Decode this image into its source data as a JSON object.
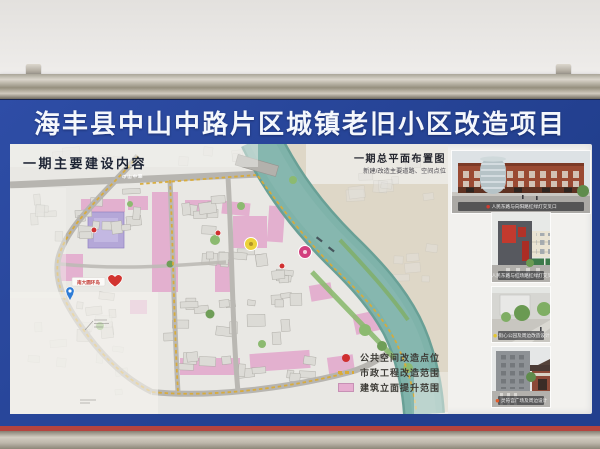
{
  "header": {
    "title": "海丰县中山中路片区城镇老旧小区改造项目"
  },
  "map": {
    "section_title": "一期主要建设内容",
    "plan_title": "一期总平面布置图",
    "plan_subtitle": "新建/改造主要道路、空间点位",
    "road_label": "中山中路",
    "poi_label": "南大圆环岛",
    "legend": [
      {
        "label": "公共空间改造点位",
        "marker": "red-dot",
        "color": "#cf2f2f"
      },
      {
        "label": "市政工程改造范围",
        "marker": "orange-dashed-line",
        "color": "#d9ab38"
      },
      {
        "label": "建筑立面提升范围",
        "marker": "pink-area",
        "color": "#e3abcd"
      }
    ]
  },
  "photos": [
    {
      "caption": "人民东路与向阳路红绿灯交叉口",
      "dot_color": "#d23c30"
    },
    {
      "caption": "人民东路与红场路红绿灯交叉口",
      "dot_color": "#d23c30"
    },
    {
      "caption": "街心公园及周边改造设计",
      "dot_color": "#e4c62e"
    },
    {
      "caption": "灵符宫广场及周边设计",
      "dot_color": "#e05a2a"
    }
  ],
  "colors": {
    "board_blue": "#2b4a9c",
    "accent_red": "#b5443e",
    "frame_metal": "#c9c3b7",
    "river_teal": "#7fb3aa",
    "facade_pink": "#e3abcd",
    "municipal_yellow": "#d9ab38",
    "public_point_red": "#cf2f2f"
  }
}
